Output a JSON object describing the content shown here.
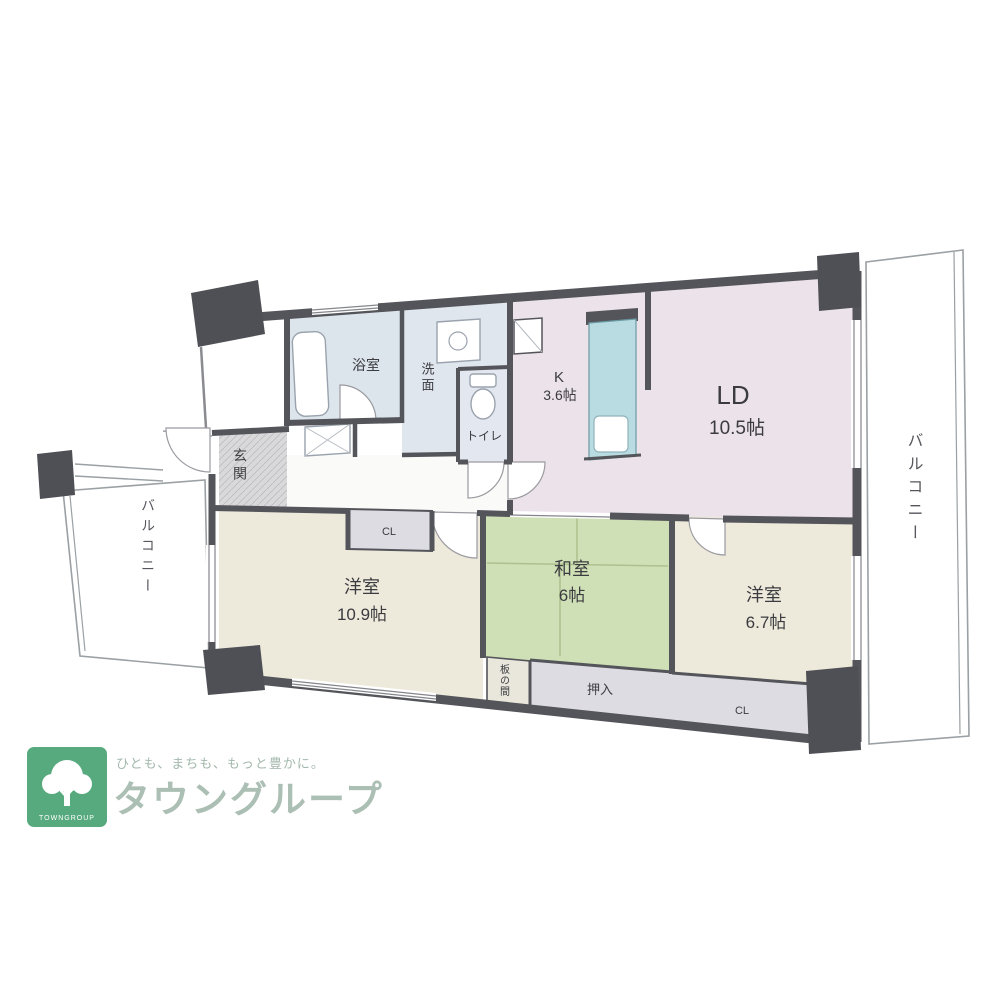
{
  "floorplan": {
    "rooms": {
      "ld": {
        "label": "LD",
        "size": "10.5帖"
      },
      "kitchen": {
        "label": "K",
        "size": "3.6帖"
      },
      "western_10_9": {
        "label": "洋室",
        "size": "10.9帖"
      },
      "washitsu": {
        "label": "和室",
        "size": "6帖"
      },
      "western_6_7": {
        "label": "洋室",
        "size": "6.7帖"
      },
      "bath": {
        "label": "浴室"
      },
      "washroom": {
        "label": "洗面"
      },
      "toilet": {
        "label": "トイレ"
      },
      "entrance": {
        "label": "玄関"
      },
      "balcony_right": {
        "label": "バルコニー"
      },
      "balcony_left": {
        "label": "バルコニー"
      },
      "closet_top": {
        "label": "CL"
      },
      "closet_bottom": {
        "label": "CL"
      },
      "oshiire": {
        "label": "押入"
      },
      "itanoma": {
        "label": "板の間"
      }
    },
    "colors": {
      "wall": "#54555a",
      "ld_floor": "#ebe3e9",
      "bedroom_floor": "#edeadb",
      "tatami_floor": "#cfe0b6",
      "wet_area_floor": "#dde4ec",
      "closet_floor": "#dcdce2",
      "entrance_floor": "#d9d9db",
      "kitchen_counter": "#b8dce1"
    }
  },
  "logo": {
    "tagline": "ひとも、まちも、もっと豊かに。",
    "company": "タウングループ",
    "mark_text": "TOWNGROUP",
    "brand_green": "#57aa7e"
  }
}
